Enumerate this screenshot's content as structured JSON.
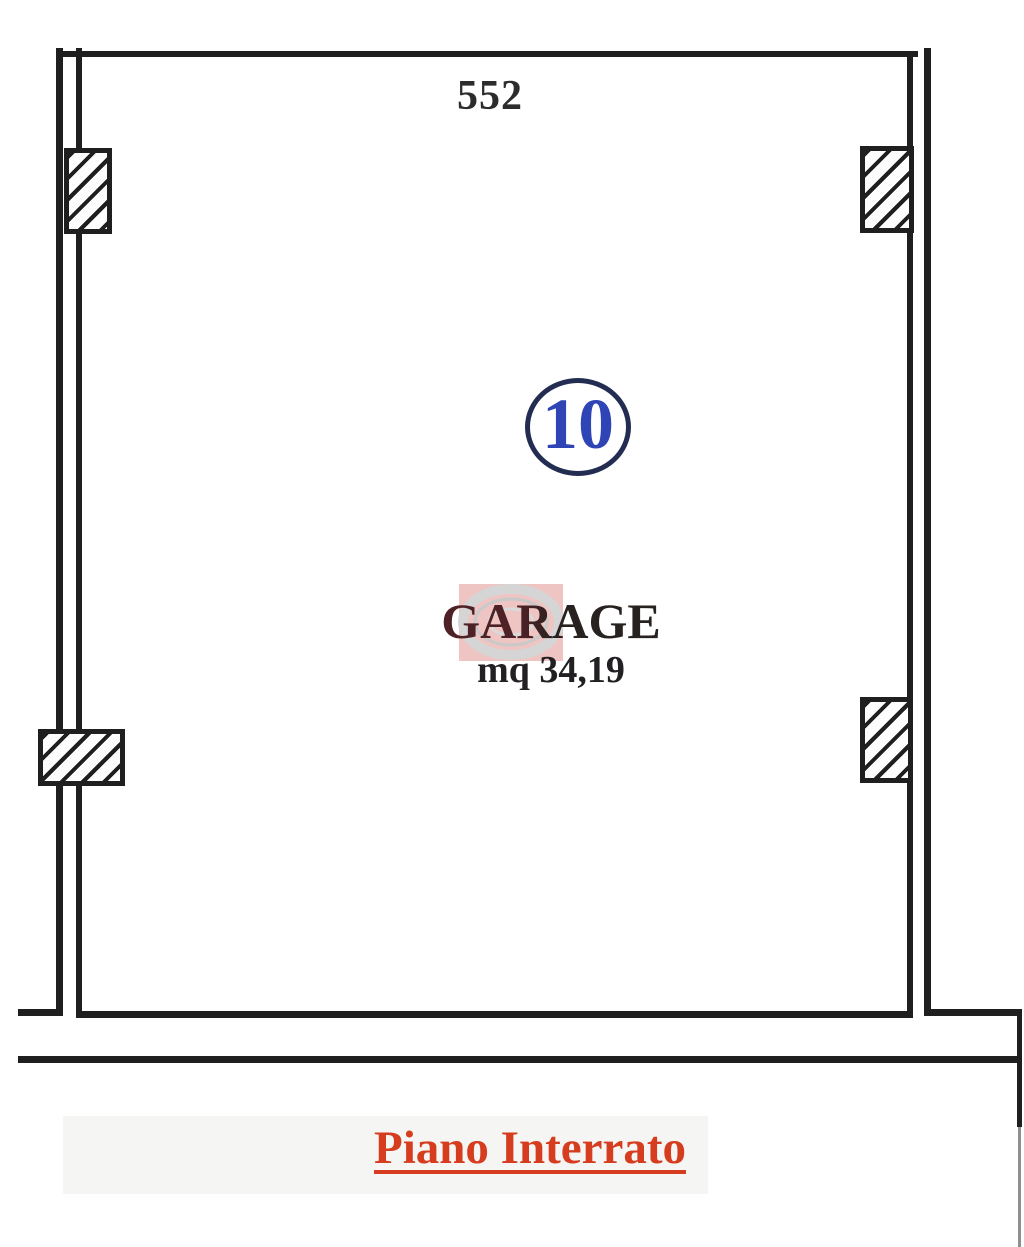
{
  "plan": {
    "dimension_top": "552",
    "unit_number": "10",
    "room_name": "GARAGE",
    "room_area": "mq 34,19",
    "floor_title": "Piano Interrato"
  },
  "colors": {
    "wall_line": "#1f1f1f",
    "floor_title_red": "#d63c1e",
    "unit_number_blue": "#2f45b5",
    "unit_circle_navy": "#232d52",
    "room_name_dark": "#27211f",
    "room_name_maroon": "#4d2126",
    "dimension_dark": "#2c2c2c",
    "watermark_pink": "#eec5c2",
    "watermark_ring_grey": "#d5d5d5"
  }
}
